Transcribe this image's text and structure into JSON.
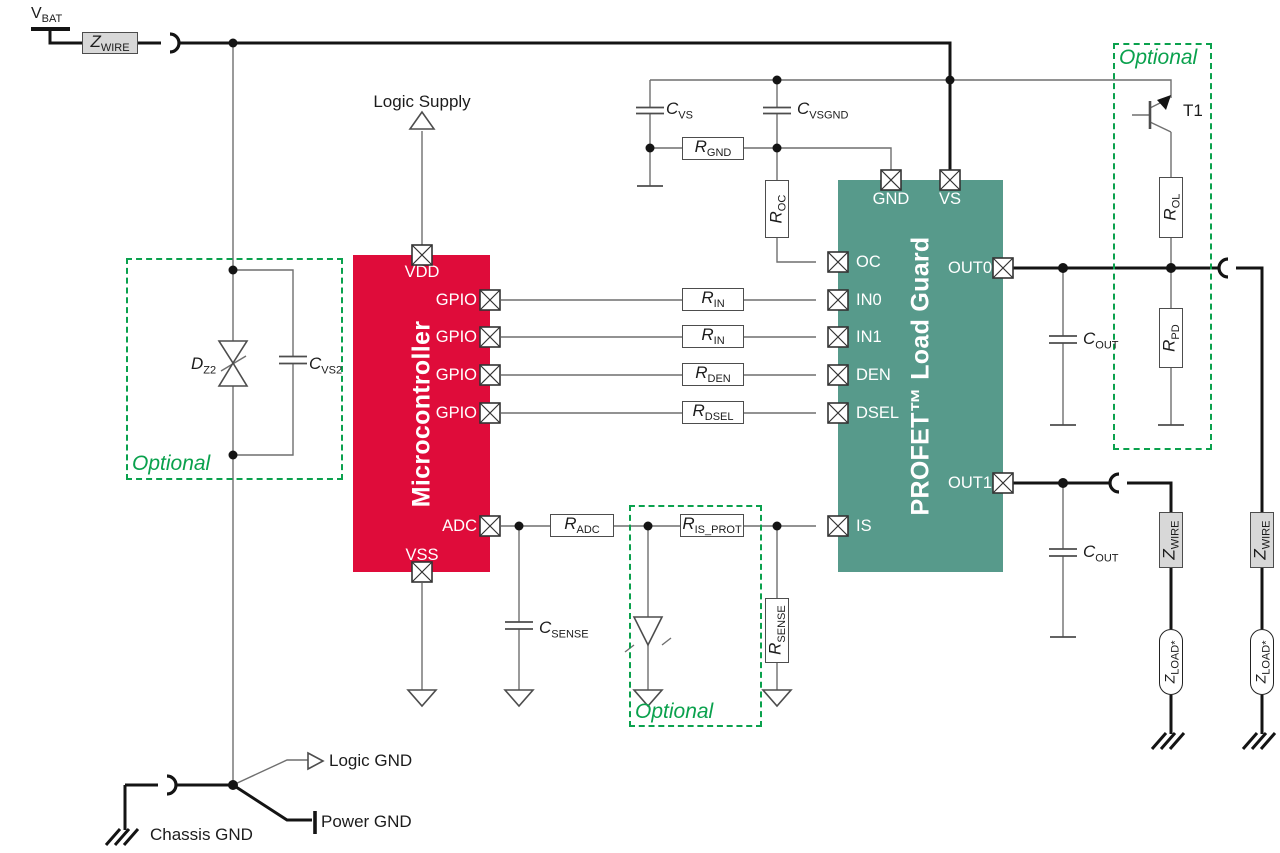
{
  "colors": {
    "red": "#df0c3a",
    "green": "#579a8b",
    "opt": "#0aa14d",
    "grayfill": "#d8d8d8",
    "wire-thin": "#6f6f6f",
    "wire-thick": "#141414",
    "sym": "#4d4d4d",
    "ink": "#1c1c1c"
  },
  "labels": {
    "v_bat": {
      "main": "V",
      "sub": "BAT"
    },
    "logic_supply": "Logic Supply",
    "t1": "T1",
    "optional": "Optional",
    "logic_gnd": "Logic GND",
    "power_gnd": "Power GND",
    "chassis_gnd": "Chassis GND"
  },
  "blocks": {
    "microcontroller": {
      "title": "Microcontroller",
      "pins": {
        "vdd": "VDD",
        "gpio": "GPIO",
        "adc": "ADC",
        "vss": "VSS"
      }
    },
    "profet": {
      "title": "PROFET™ Load Guard",
      "pins": {
        "gnd": "GND",
        "vs": "VS",
        "oc": "OC",
        "in0": "IN0",
        "in1": "IN1",
        "den": "DEN",
        "dsel": "DSEL",
        "is": "IS",
        "out0": "OUT0",
        "out1": "OUT1"
      }
    }
  },
  "components": {
    "z_wire": {
      "main": "Z",
      "sub": "WIRE"
    },
    "z_load": {
      "main": "Z",
      "sub": "LOAD*"
    },
    "r_in": {
      "main": "R",
      "sub": "IN"
    },
    "r_den": {
      "main": "R",
      "sub": "DEN"
    },
    "r_dsel": {
      "main": "R",
      "sub": "DSEL"
    },
    "r_adc": {
      "main": "R",
      "sub": "ADC"
    },
    "r_is_prot": {
      "main": "R",
      "sub": "IS_PROT"
    },
    "r_sense": {
      "main": "R",
      "sub": "SENSE"
    },
    "c_sense": {
      "main": "C",
      "sub": "SENSE"
    },
    "c_vs": {
      "main": "C",
      "sub": "VS"
    },
    "c_vsgnd": {
      "main": "C",
      "sub": "VSGND"
    },
    "c_vs2": {
      "main": "C",
      "sub": "VS2"
    },
    "r_gnd": {
      "main": "R",
      "sub": "GND"
    },
    "r_oc": {
      "main": "R",
      "sub": "OC"
    },
    "c_out": {
      "main": "C",
      "sub": "OUT"
    },
    "r_ol": {
      "main": "R",
      "sub": "OL"
    },
    "r_pd": {
      "main": "R",
      "sub": "PD"
    },
    "d_z2": {
      "main": "D",
      "sub": "Z2"
    }
  }
}
